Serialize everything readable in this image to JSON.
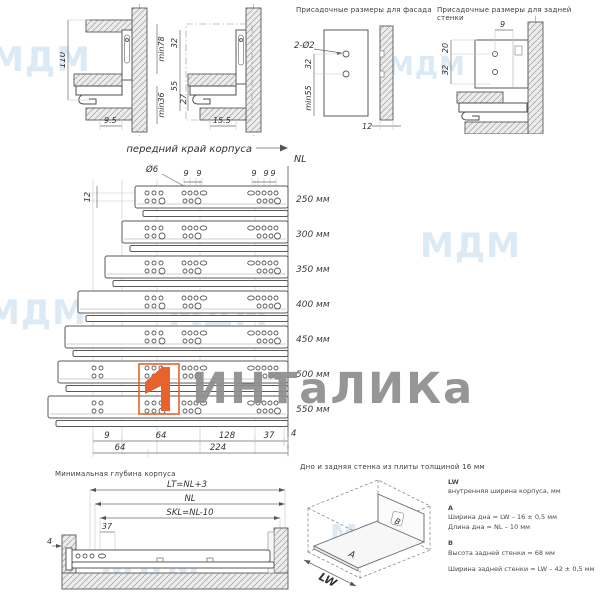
{
  "brand": {
    "logo_text": "ИНТаЛИКа",
    "bg_watermark": "МДМ",
    "accent_color": "#e8622d",
    "logo_text_color": "#8f8f8f"
  },
  "side_views": {
    "left": {
      "dim_height": "110",
      "dim_min_top": "min78",
      "dim_min_bottom": "min36",
      "dim_front_gap": "9.5"
    },
    "right": {
      "dim_top": "32",
      "dim_mid": "55",
      "dim_inner": "27",
      "dim_front_gap": "15.5"
    }
  },
  "facade_drill": {
    "title": "Присадочные размеры для фасада",
    "holes": "2-Ø2",
    "dim_between": "32",
    "dim_min": "min55",
    "dim_thickness": "12"
  },
  "back_drill": {
    "title": "Присадочные размеры для задней стенки",
    "dim_top": "9",
    "dim_upper": "20",
    "dim_lower": "32"
  },
  "slides": {
    "front_edge": "передний край корпуса",
    "nl": "NL",
    "hole_dia": "Ø6",
    "dim_row_gap": "12",
    "mid_dims": [
      "9",
      "9"
    ],
    "right_dims": [
      "9",
      "9",
      "9"
    ],
    "rows": [
      {
        "label": "250 мм"
      },
      {
        "label": "300 мм"
      },
      {
        "label": "350 мм"
      },
      {
        "label": "400 мм"
      },
      {
        "label": "450 мм"
      },
      {
        "label": "500 мм"
      },
      {
        "label": "550 мм"
      }
    ],
    "bottom_dims": [
      "9",
      "64",
      "128",
      "37"
    ],
    "dim_end": "4",
    "bottom_dims2": [
      "64",
      "224"
    ]
  },
  "min_depth": {
    "title": "Минимальная глубина корпуса",
    "dim_lt": "LT=NL+3",
    "dim_nl": "NL",
    "dim_skl": "SKL=NL-10",
    "dim_37": "37",
    "dim_4": "4"
  },
  "box_panel": {
    "title": "Дно и задняя стенка из плиты толщиной 16 мм",
    "label_a": "A",
    "label_b": "B",
    "label_lw": "LW",
    "legend_lw_head": "LW",
    "legend_lw_desc": "внутренняя ширина корпуса, мм",
    "legend_a_head": "A",
    "legend_a_line1": "Ширина дна = LW – 16 ± 0,5 мм",
    "legend_a_line2": "Длина дна = NL – 10 мм",
    "legend_b_head": "B",
    "legend_b_line1": "Высота задней стенки = 68 мм",
    "legend_b_line2": "Ширина задней стенки = LW – 42 ± 0,5 мм"
  }
}
